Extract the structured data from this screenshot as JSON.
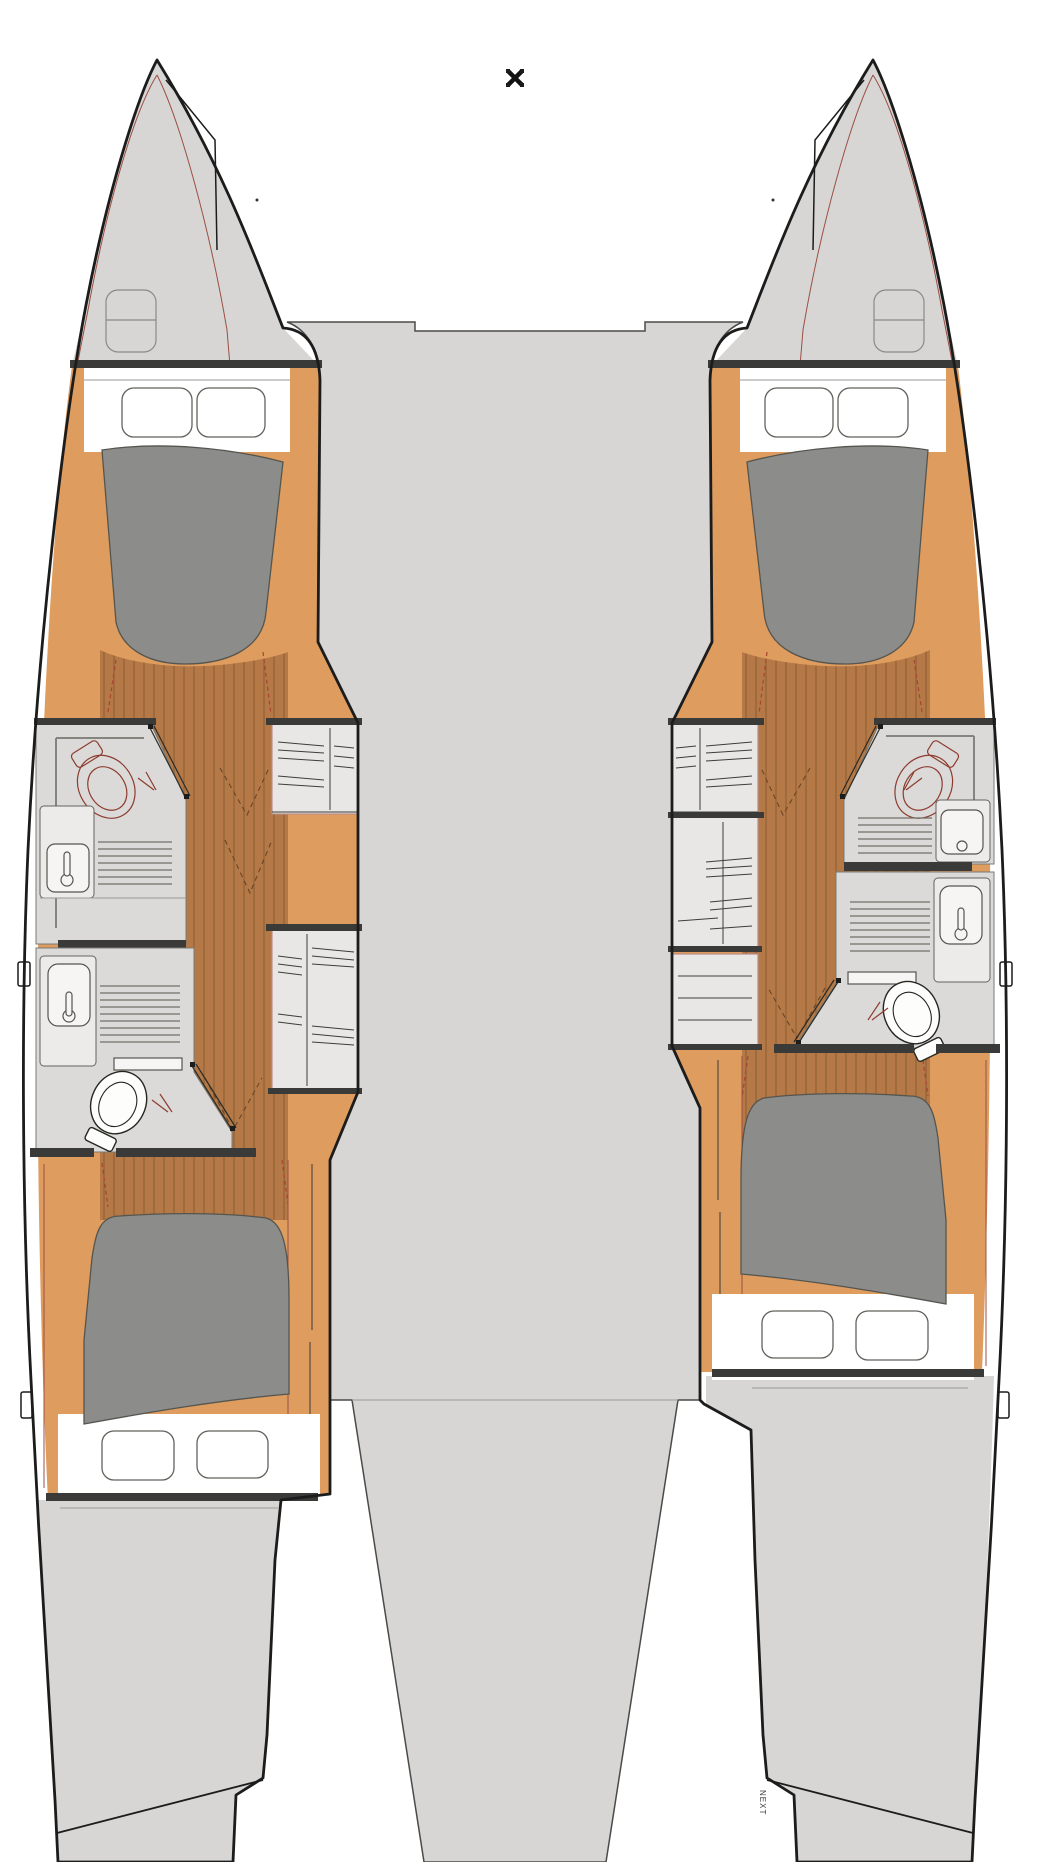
{
  "labels": {
    "footer_vertical": "NEXT"
  },
  "icons": {
    "mast_marker": "crossed-square-marker"
  },
  "colors": {
    "background": "#ffffff",
    "hull_gray": "#d7d6d4",
    "outline_black": "#1c1c1c",
    "wood_light": "#de9c5f",
    "wood_dark": "#b47946",
    "plank_line": "#80552f",
    "mattress_gray": "#8c8c8a",
    "bed_white": "#ffffff",
    "bathroom_gray": "#dbdad8",
    "wall_dark": "#3a3a38",
    "fixture_red": "#8d3c2f",
    "accent_red": "#9b4f43",
    "cabinet_gray": "#e8e7e5"
  }
}
